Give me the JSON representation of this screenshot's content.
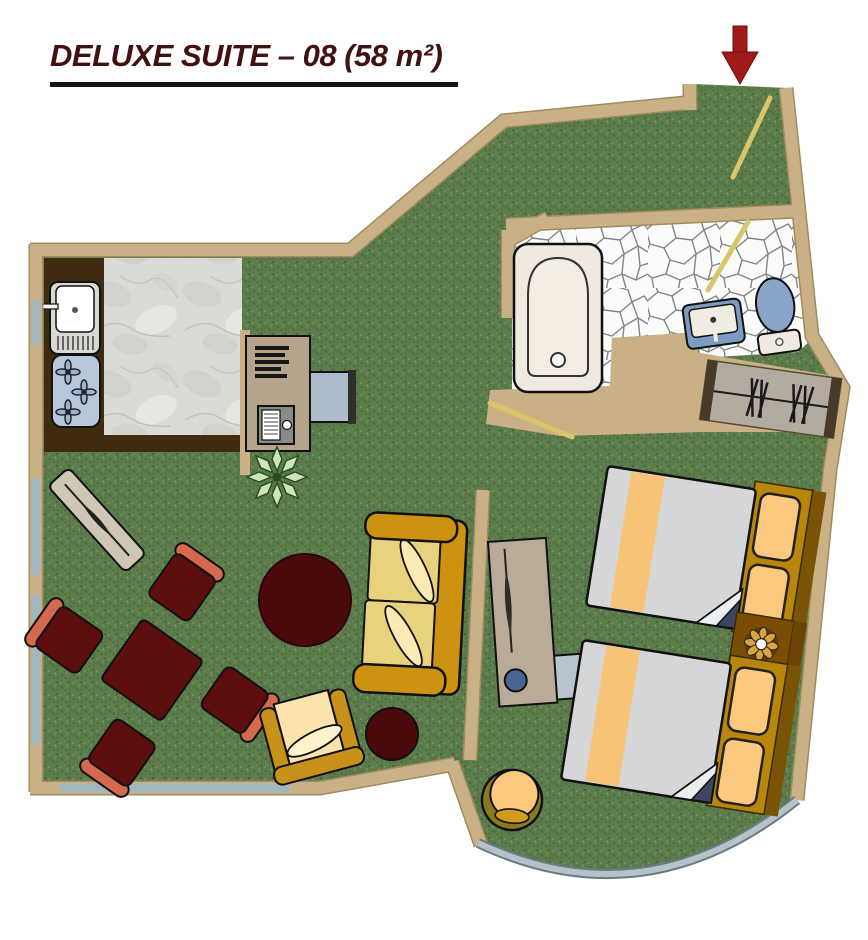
{
  "title": {
    "text": "DELUXE SUITE – 08 (58 m²)"
  },
  "plan": {
    "entrance_marker": "entrance-arrow-down",
    "rooms": [
      "living-room",
      "kitchenette",
      "hallway",
      "bathroom",
      "bedroom"
    ],
    "doors": [
      "entrance-door",
      "bathroom-door",
      "bedroom-door"
    ],
    "fixtures": [
      "kitchen-sink",
      "stove-3-burners",
      "marble-floor",
      "mosaic-floor",
      "bathtub",
      "washbasin",
      "toilet",
      "wardrobe-with-hangers",
      "windows-left-wall",
      "window-bottom-wall",
      "curved-window-bedroom"
    ],
    "furniture": [
      "desk-with-books",
      "desk-computer",
      "desk-chair",
      "plant",
      "ironing-board",
      "dining-table",
      "dining-chair",
      "round-rug",
      "sofa",
      "small-armchair",
      "pouf",
      "dresser-with-mirror",
      "dresser-chair",
      "bed-1",
      "bed-2",
      "nightstand-with-ornament",
      "bedroom-armchair"
    ]
  },
  "colors": {
    "title_text": "#431010",
    "underline": "#17130d",
    "arrow": "#a01a1a",
    "wall": "#c9b185",
    "carpet_green": "#5b7b4b",
    "kitchen_counter": "#402a10",
    "marble": "#dadad7",
    "window": "#a3b6bd",
    "door": "#d8c76a",
    "bed_duvet": "#d5d6d8",
    "bed_stripe": "#f6c377",
    "headboard": "#b8860b",
    "pillow": "#fbc87e",
    "sofa_frame": "#cc9210",
    "sofa_cushion": "#e9d27d",
    "dining_red": "#5c0d0d",
    "chair_back_salmon": "#d4694d",
    "rug": "#4a0a0c",
    "bath_fixture_blue": "#7b9cc0"
  }
}
